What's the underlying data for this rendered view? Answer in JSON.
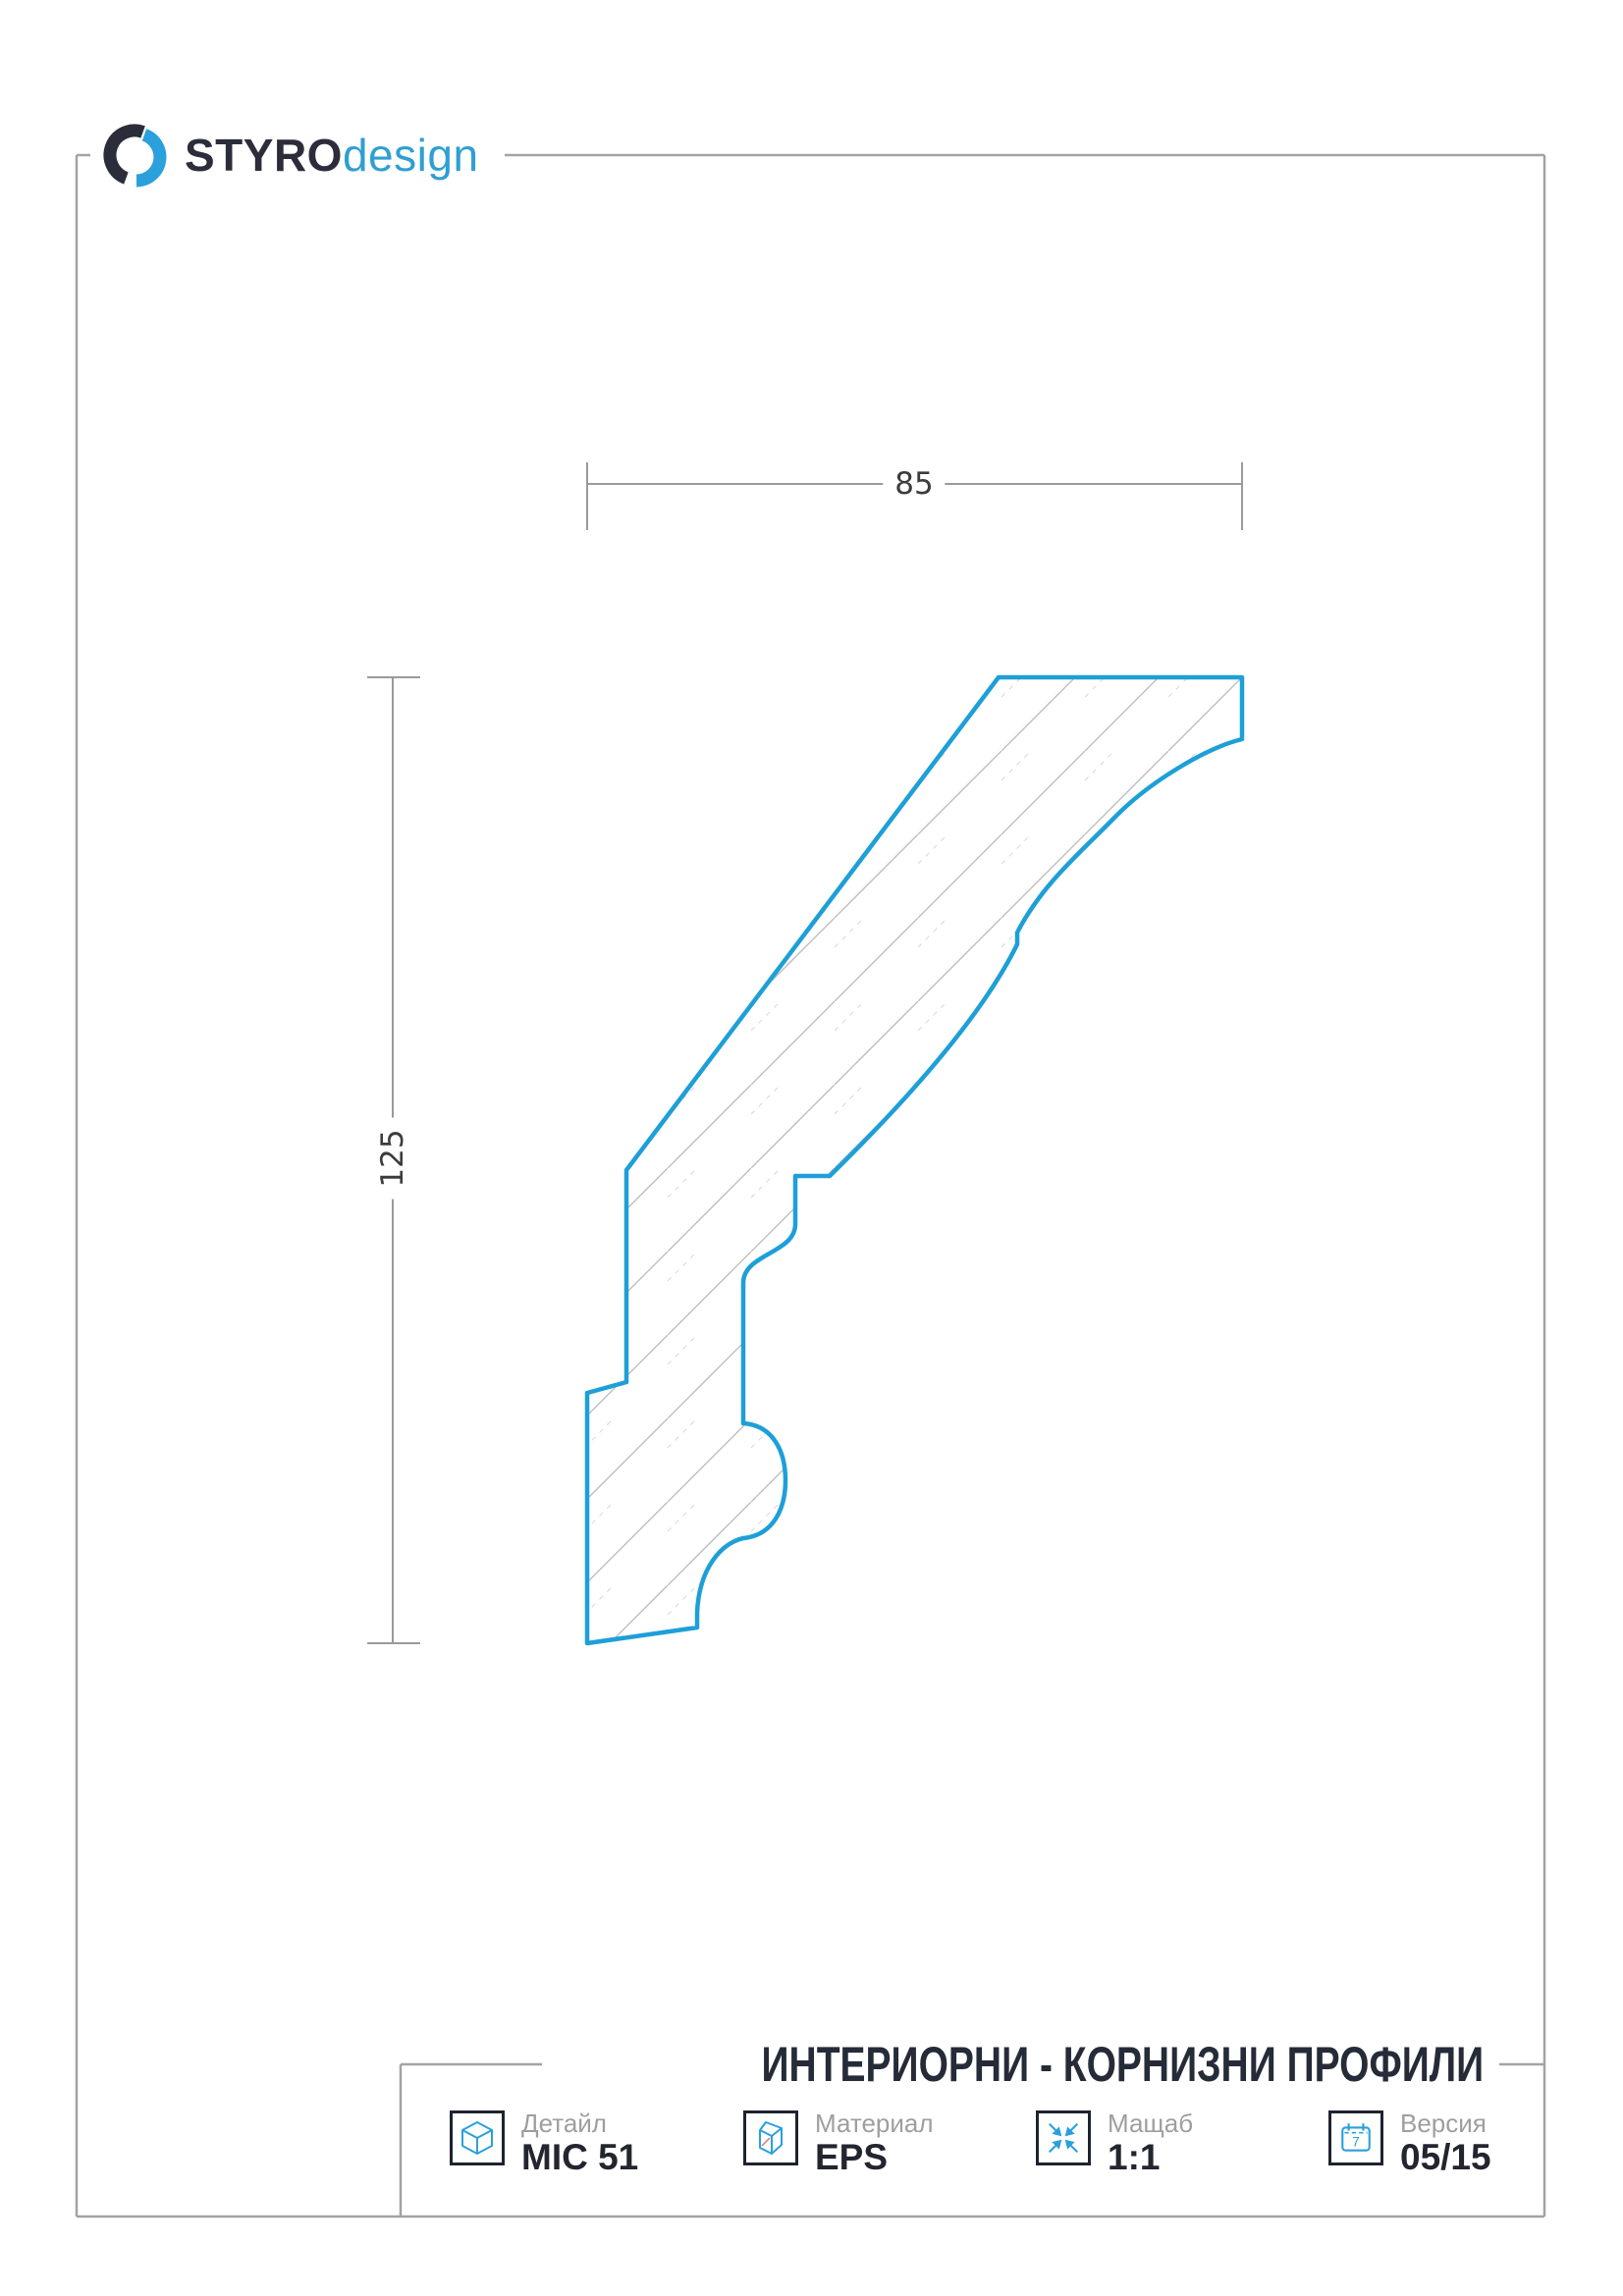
{
  "brand": {
    "name_bold": "STYRO",
    "name_light": "design"
  },
  "drawing": {
    "width_dim": "85",
    "height_dim": "125"
  },
  "title_block": {
    "title": "ИНТЕРИОРНИ - КОРНИЗНИ ПРОФИЛИ",
    "cells": [
      {
        "label": "Детайл",
        "value": "MIC 51",
        "icon": "detail-cube-icon"
      },
      {
        "label": "Материал",
        "value": "EPS",
        "icon": "material-cube-icon"
      },
      {
        "label": "Мащаб",
        "value": "1:1",
        "icon": "scale-arrows-icon"
      },
      {
        "label": "Версия",
        "value": "05/15",
        "icon": "calendar-icon",
        "calendar_digit": "7"
      }
    ]
  },
  "colors": {
    "profile_blue": "#1e9fd8",
    "logo_blue": "#2aa0dc",
    "logo_dark": "#2b2d3a",
    "frame_gray": "#a3a3a3",
    "dim_gray": "#9a9a9a",
    "hatch_gray": "#b9b9b9",
    "text_dark": "#23252f",
    "label_gray": "#9e9e9e"
  }
}
